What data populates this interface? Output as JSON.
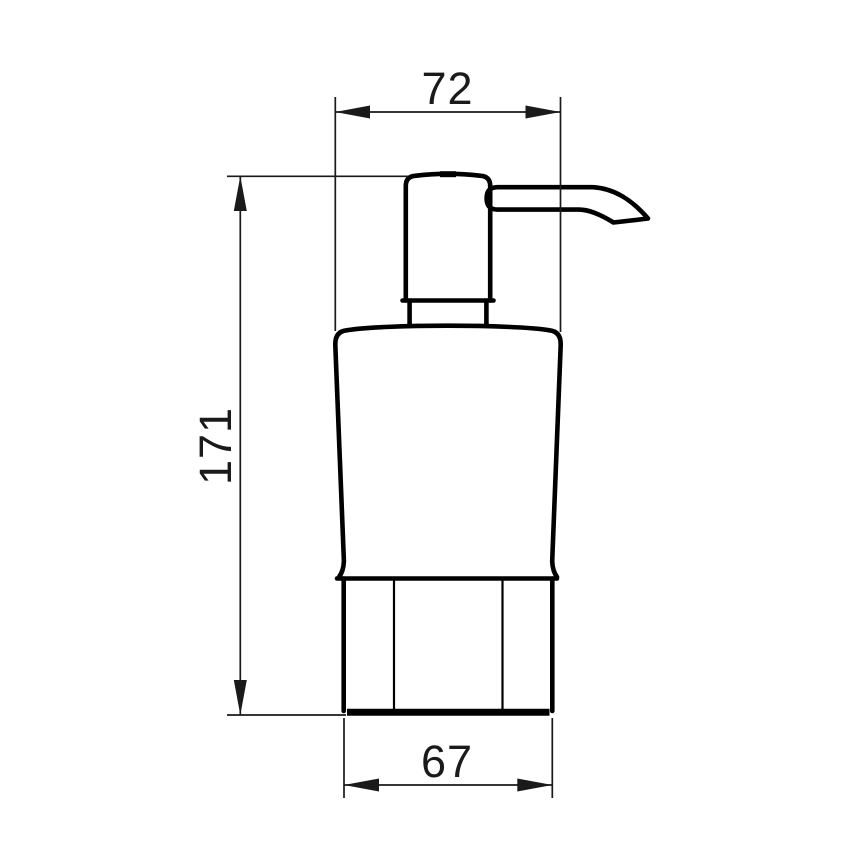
{
  "canvas": {
    "background_color": "#ffffff",
    "object_line_color": "#000000",
    "dimension_line_color": "#1a1a1a"
  },
  "drawing": {
    "subject": "soap-dispenser-front-elevation"
  },
  "dimensions": {
    "top_width": "72",
    "height": "171",
    "bottom_width": "67"
  }
}
